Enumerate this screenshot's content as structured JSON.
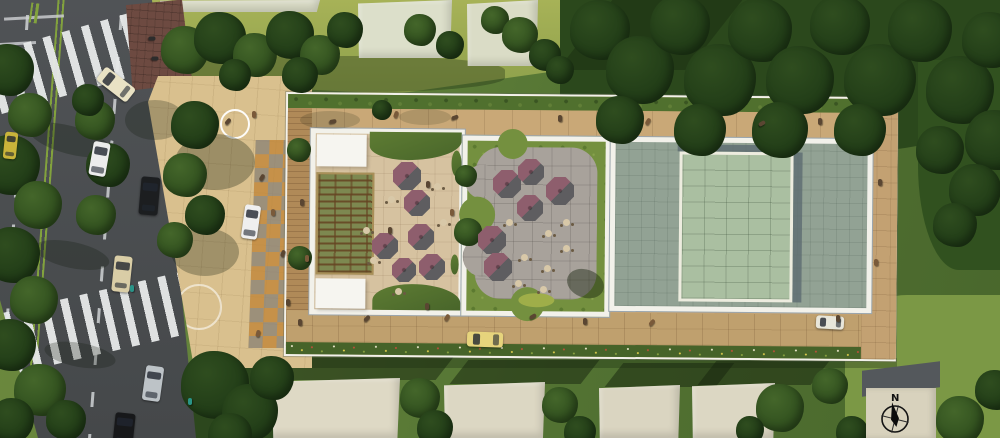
{
  "meta": {
    "description": "Aerial architectural site-plan rendering with street, plaza, umbrella terraces, gridded roof and compass kiosk"
  },
  "compass": {
    "label": "N"
  },
  "palette": {
    "grass_base": "#5d7a36",
    "road": "#4b4e50",
    "road_median": "#82a23d",
    "sidewalk_brick": "#6d4a41",
    "plaza_paving": "#d9c08e",
    "checker_orange": "#c08436",
    "checker_gray": "#8b8274",
    "walk_tan": "#c5a474",
    "deck_wood": "#b08a58",
    "frame_white": "#f2f1ea",
    "t1_floor": "#d6c2a0",
    "t2_stone": "#a8a29b",
    "t2_green": "#74903f",
    "roof_big": "#92a294",
    "skylight": "#aabfa1",
    "umbrella_plum": "#8e5e6d",
    "umbrella_shadow": "#5e5d60"
  },
  "scene": {
    "trees": [
      [
        8,
        70,
        26,
        "d"
      ],
      [
        30,
        115,
        22,
        "m"
      ],
      [
        10,
        165,
        30,
        "d"
      ],
      [
        38,
        205,
        24,
        "m"
      ],
      [
        12,
        255,
        28,
        "d"
      ],
      [
        34,
        300,
        24,
        "m"
      ],
      [
        10,
        345,
        26,
        "d"
      ],
      [
        40,
        390,
        26,
        "m"
      ],
      [
        12,
        420,
        22,
        "d"
      ],
      [
        66,
        420,
        20,
        "d"
      ],
      [
        95,
        120,
        20,
        "m"
      ],
      [
        108,
        165,
        22,
        "d"
      ],
      [
        96,
        215,
        20,
        "m"
      ],
      [
        88,
        100,
        16,
        "d"
      ],
      [
        195,
        125,
        24,
        "d"
      ],
      [
        185,
        175,
        22,
        "m"
      ],
      [
        205,
        215,
        20,
        "d"
      ],
      [
        175,
        240,
        18,
        "m"
      ],
      [
        185,
        50,
        24,
        "m"
      ],
      [
        220,
        38,
        26,
        "d"
      ],
      [
        255,
        55,
        22,
        "m"
      ],
      [
        290,
        35,
        24,
        "d"
      ],
      [
        320,
        55,
        20,
        "m"
      ],
      [
        345,
        30,
        18,
        "d"
      ],
      [
        300,
        75,
        18,
        "d"
      ],
      [
        235,
        75,
        16,
        "d"
      ],
      [
        420,
        30,
        16,
        "m"
      ],
      [
        450,
        45,
        14,
        "d"
      ],
      [
        495,
        20,
        14,
        "m"
      ],
      [
        520,
        35,
        18,
        "m"
      ],
      [
        545,
        55,
        16,
        "d"
      ],
      [
        560,
        70,
        14,
        "d"
      ],
      [
        600,
        30,
        30,
        "d"
      ],
      [
        640,
        70,
        34,
        "d"
      ],
      [
        680,
        25,
        30,
        "d"
      ],
      [
        720,
        80,
        36,
        "d"
      ],
      [
        760,
        30,
        32,
        "d"
      ],
      [
        800,
        80,
        34,
        "d"
      ],
      [
        840,
        25,
        30,
        "d"
      ],
      [
        880,
        80,
        36,
        "d"
      ],
      [
        920,
        30,
        32,
        "d"
      ],
      [
        960,
        90,
        34,
        "d"
      ],
      [
        990,
        40,
        28,
        "d"
      ],
      [
        995,
        140,
        30,
        "d"
      ],
      [
        700,
        130,
        26,
        "d"
      ],
      [
        780,
        130,
        28,
        "d"
      ],
      [
        860,
        130,
        26,
        "d"
      ],
      [
        940,
        150,
        24,
        "d"
      ],
      [
        620,
        120,
        24,
        "d"
      ],
      [
        975,
        190,
        26,
        "d"
      ],
      [
        955,
        225,
        22,
        "d"
      ],
      [
        420,
        398,
        20,
        "m"
      ],
      [
        435,
        428,
        18,
        "d"
      ],
      [
        560,
        405,
        18,
        "m"
      ],
      [
        580,
        432,
        16,
        "d"
      ],
      [
        780,
        408,
        24,
        "m"
      ],
      [
        830,
        386,
        18,
        "m"
      ],
      [
        852,
        432,
        16,
        "d"
      ],
      [
        750,
        430,
        14,
        "d"
      ],
      [
        215,
        385,
        34,
        "d"
      ],
      [
        250,
        412,
        28,
        "d"
      ],
      [
        272,
        378,
        22,
        "d"
      ],
      [
        230,
        435,
        22,
        "d"
      ],
      [
        960,
        420,
        24,
        "m"
      ],
      [
        995,
        390,
        20,
        "d"
      ],
      [
        299,
        150,
        12,
        "m"
      ],
      [
        300,
        258,
        12,
        "m"
      ],
      [
        382,
        110,
        10,
        "d"
      ],
      [
        466,
        176,
        11,
        "m"
      ],
      [
        468,
        232,
        14,
        "m"
      ]
    ],
    "tree_shadows": [
      [
        70,
        140,
        42,
        14,
        0.28,
        15
      ],
      [
        72,
        255,
        38,
        13,
        0.26,
        12
      ],
      [
        80,
        355,
        36,
        12,
        0.25,
        10
      ],
      [
        215,
        162,
        40,
        28,
        0.3,
        0
      ],
      [
        205,
        252,
        34,
        24,
        0.28,
        0
      ],
      [
        155,
        120,
        30,
        20,
        0.25,
        0
      ],
      [
        330,
        120,
        30,
        9,
        0.16,
        0
      ],
      [
        425,
        117,
        26,
        8,
        0.14,
        0
      ]
    ],
    "umbrellas": [
      [
        407,
        176,
        14
      ],
      [
        417,
        203,
        13
      ],
      [
        421,
        237,
        13
      ],
      [
        385,
        246,
        13
      ],
      [
        404,
        270,
        12
      ],
      [
        432,
        267,
        13
      ],
      [
        507,
        184,
        14
      ],
      [
        531,
        172,
        13
      ],
      [
        560,
        191,
        14
      ],
      [
        530,
        208,
        13
      ],
      [
        492,
        240,
        14
      ],
      [
        498,
        267,
        14
      ]
    ],
    "tables": [
      [
        391,
        199
      ],
      [
        373,
        260
      ],
      [
        443,
        222
      ],
      [
        437,
        186
      ],
      [
        398,
        291
      ],
      [
        366,
        230
      ],
      [
        566,
        222
      ],
      [
        548,
        233
      ],
      [
        566,
        248
      ],
      [
        524,
        257
      ],
      [
        547,
        268
      ],
      [
        518,
        283
      ],
      [
        543,
        289
      ],
      [
        509,
        222
      ]
    ],
    "cars": [
      [
        116,
        84,
        38,
        17,
        38,
        "#e9e2c4",
        "car-cream-turning"
      ],
      [
        99,
        159,
        17,
        34,
        10,
        "#ececec",
        "car-white"
      ],
      [
        10,
        145,
        13,
        27,
        6,
        "#c9b43a",
        "car-yellow-small"
      ],
      [
        149,
        196,
        19,
        38,
        5,
        "#1c1e20",
        "car-black-suv"
      ],
      [
        122,
        274,
        18,
        36,
        6,
        "#d9cda6",
        "car-beige"
      ],
      [
        153,
        383,
        18,
        35,
        8,
        "#bdc3c7",
        "car-silver"
      ],
      [
        124,
        430,
        20,
        34,
        6,
        "#17181a",
        "car-black"
      ],
      [
        251,
        222,
        16,
        34,
        8,
        "#efefef",
        "car-white-plaza"
      ],
      [
        485,
        339,
        36,
        15,
        2,
        "#e6d47c",
        "car-yellow-site"
      ],
      [
        830,
        322,
        28,
        13,
        3,
        "#e8e6da",
        "car-white-site"
      ]
    ],
    "people": [
      [
        228,
        121,
        40,
        "#5a4632"
      ],
      [
        254,
        114,
        0,
        "#7a5a3a"
      ],
      [
        262,
        177,
        30,
        "#5a4632"
      ],
      [
        273,
        212,
        0,
        "#7a5a3a"
      ],
      [
        283,
        253,
        20,
        "#5a4632"
      ],
      [
        288,
        302,
        0,
        "#5a4632"
      ],
      [
        258,
        333,
        15,
        "#7a5a3a"
      ],
      [
        300,
        322,
        0,
        "#5a4632"
      ],
      [
        307,
        258,
        0,
        "#7a5a3a"
      ],
      [
        302,
        202,
        0,
        "#5a4632"
      ],
      [
        333,
        121,
        80,
        "#5a4632"
      ],
      [
        396,
        114,
        20,
        "#7a5a3a"
      ],
      [
        455,
        117,
        70,
        "#5a4632"
      ],
      [
        560,
        118,
        0,
        "#5a4632"
      ],
      [
        648,
        121,
        30,
        "#7a5a3a"
      ],
      [
        762,
        123,
        60,
        "#5a4632"
      ],
      [
        820,
        121,
        0,
        "#5a4632"
      ],
      [
        367,
        318,
        45,
        "#5a4632"
      ],
      [
        447,
        317,
        30,
        "#7a5a3a"
      ],
      [
        533,
        316,
        60,
        "#5a4632"
      ],
      [
        585,
        321,
        0,
        "#5a4632"
      ],
      [
        652,
        322,
        40,
        "#7a5a3a"
      ],
      [
        838,
        318,
        0,
        "#5a4632"
      ],
      [
        427,
        306,
        0,
        "#5a4632"
      ],
      [
        880,
        182,
        0,
        "#5a4632"
      ],
      [
        876,
        262,
        0,
        "#7a5a3a"
      ],
      [
        428,
        184,
        0,
        "#5a4632"
      ],
      [
        452,
        212,
        0,
        "#7a5a3a"
      ],
      [
        390,
        230,
        0,
        "#5a4632"
      ],
      [
        132,
        288,
        0,
        "#2a9488"
      ],
      [
        190,
        401,
        0,
        "#2a9488"
      ],
      [
        152,
        38,
        90,
        "#2c2c2c"
      ],
      [
        155,
        58,
        90,
        "#2c2c2c"
      ]
    ],
    "roofs": [
      [
        160,
        0,
        160,
        12,
        "#dadcc6",
        false
      ],
      [
        358,
        0,
        94,
        58,
        "#dcdfca",
        false
      ],
      [
        467,
        0,
        71,
        66,
        "#dadcc6",
        false
      ],
      [
        272,
        378,
        128,
        60,
        "#ded9c5",
        true
      ],
      [
        444,
        382,
        101,
        56,
        "#dcd7c3",
        true
      ],
      [
        599,
        385,
        81,
        53,
        "#dad5c1",
        true
      ],
      [
        692,
        383,
        83,
        55,
        "#dcd7c3",
        true
      ]
    ]
  }
}
